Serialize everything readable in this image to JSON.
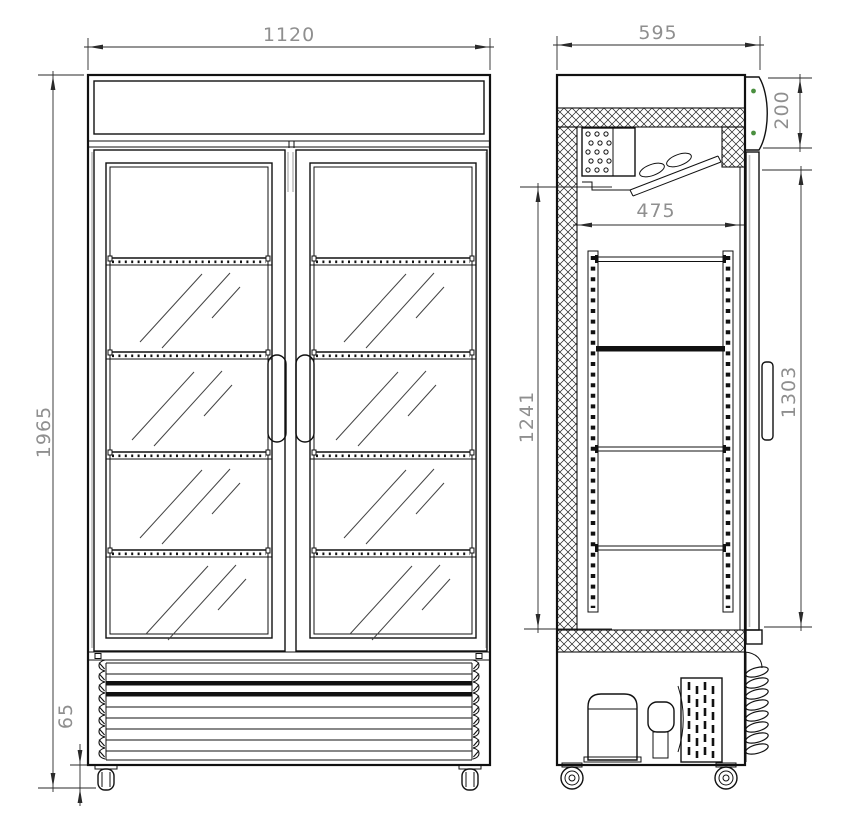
{
  "drawing": {
    "type": "technical-drawing",
    "subject": "double-glass-door-display-refrigerator",
    "dimensions": {
      "front": {
        "overall_width": "1120",
        "overall_height": "1965",
        "caster_height": "65"
      },
      "side": {
        "overall_depth": "595",
        "canopy_height": "200",
        "interior_depth": "475",
        "interior_height": "1241",
        "door_height": "1303"
      }
    },
    "colors": {
      "line": "#111111",
      "dimension_text": "#8f8f8f",
      "screw_indicator_green": "#4a8f3f"
    }
  }
}
